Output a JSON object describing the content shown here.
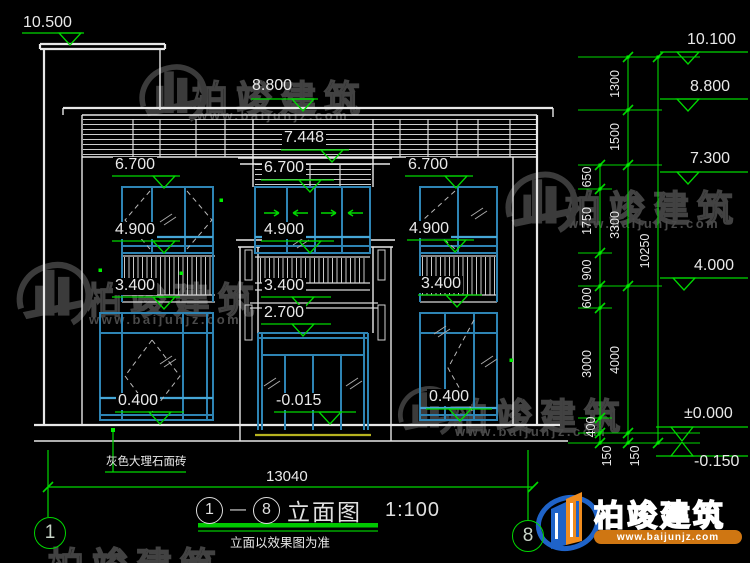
{
  "marks": {
    "m10500": "10.500",
    "m8800_top": "8.800",
    "m7448": "7.448",
    "m6700_l": "6.700",
    "m6700_c": "6.700",
    "m6700_r": "6.700",
    "m4900_l": "4.900",
    "m4900_c": "4.900",
    "m4900_r": "4.900",
    "m3400_l": "3.400",
    "m3400_c": "3.400",
    "m3400_r": "3.400",
    "m2700": "2.700",
    "m0400_l": "0.400",
    "m0400_r": "0.400",
    "m0015": "-0.015"
  },
  "right_marks": {
    "m10100": "10.100",
    "m8800": "8.800",
    "m7300": "7.300",
    "m4000": "4.000",
    "m0000": "±0.000",
    "m0150": "-0.150"
  },
  "vdims": {
    "d650": "650",
    "d1750": "1750",
    "d900": "900",
    "d600": "600",
    "d3000": "3000",
    "d400": "400",
    "d1300": "1300",
    "d1500": "1500",
    "d3300": "3300",
    "d4000": "4000",
    "d10250": "10250",
    "d150a": "150",
    "d150b": "150"
  },
  "hdims": {
    "width": "13040"
  },
  "notes": {
    "material": "灰色大理石面砖",
    "disclaimer": "立面以效果图为准"
  },
  "title": {
    "bubble_start": "1",
    "bubble_end": "8",
    "dash": "—",
    "name": "立面图",
    "scale": "1:100"
  },
  "grid": {
    "left_bubble": "1",
    "right_bubble": "8"
  },
  "watermark": {
    "brand": "柏竣建筑",
    "url": "www.baijunjz.com"
  },
  "brand_block": {
    "brand": "柏竣建筑",
    "url": "www.baijunjz.com"
  },
  "colors": {
    "line": "#e8e8e8",
    "dim_green": "#00d800",
    "frame_blue": "#2e84b4",
    "transom_cyan": "#46a6d6",
    "plinth_yellow": "#b7b320"
  }
}
